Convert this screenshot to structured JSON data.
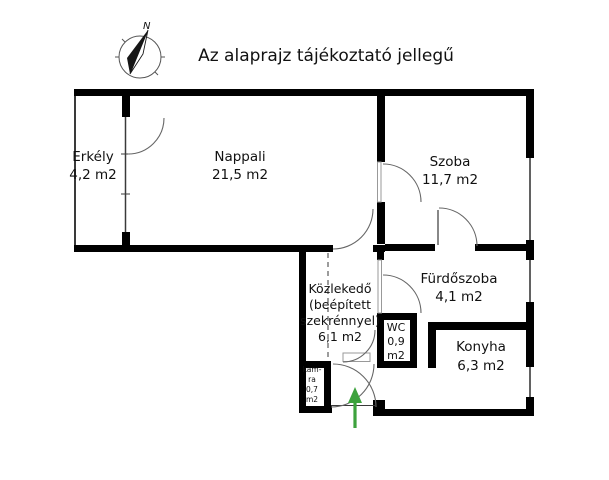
{
  "title": "Az alaprajz tájékoztató jellegű",
  "compass": {
    "label": "N"
  },
  "rooms": {
    "erkely": {
      "name": "Erkély",
      "area": "4,2 m2"
    },
    "nappali": {
      "name": "Nappali",
      "area": "21,5 m2"
    },
    "szoba": {
      "name": "Szoba",
      "area": "11,7 m2"
    },
    "furdoszoba": {
      "name": "Fürdőszoba",
      "area": "4,1 m2"
    },
    "kozlekedo": {
      "name": "Közlekedő",
      "note_line1": "(beépített",
      "note_line2": "szekrénnyel)",
      "area": "6,1 m2"
    },
    "wc": {
      "name": "WC",
      "area_line1": "0,9",
      "area_line2": "m2"
    },
    "konyha": {
      "name": "Konyha",
      "area": "6,3 m2"
    },
    "kamra": {
      "name_line1": "kam-",
      "name_line2": "ra",
      "area_line1": "0,7",
      "area_line2": "m2"
    }
  },
  "colors": {
    "background": "#ffffff",
    "wall": "#000000",
    "thin_line": "#3a3a3a",
    "arc_line": "#666666",
    "entrance_arrow": "#3da23d"
  }
}
